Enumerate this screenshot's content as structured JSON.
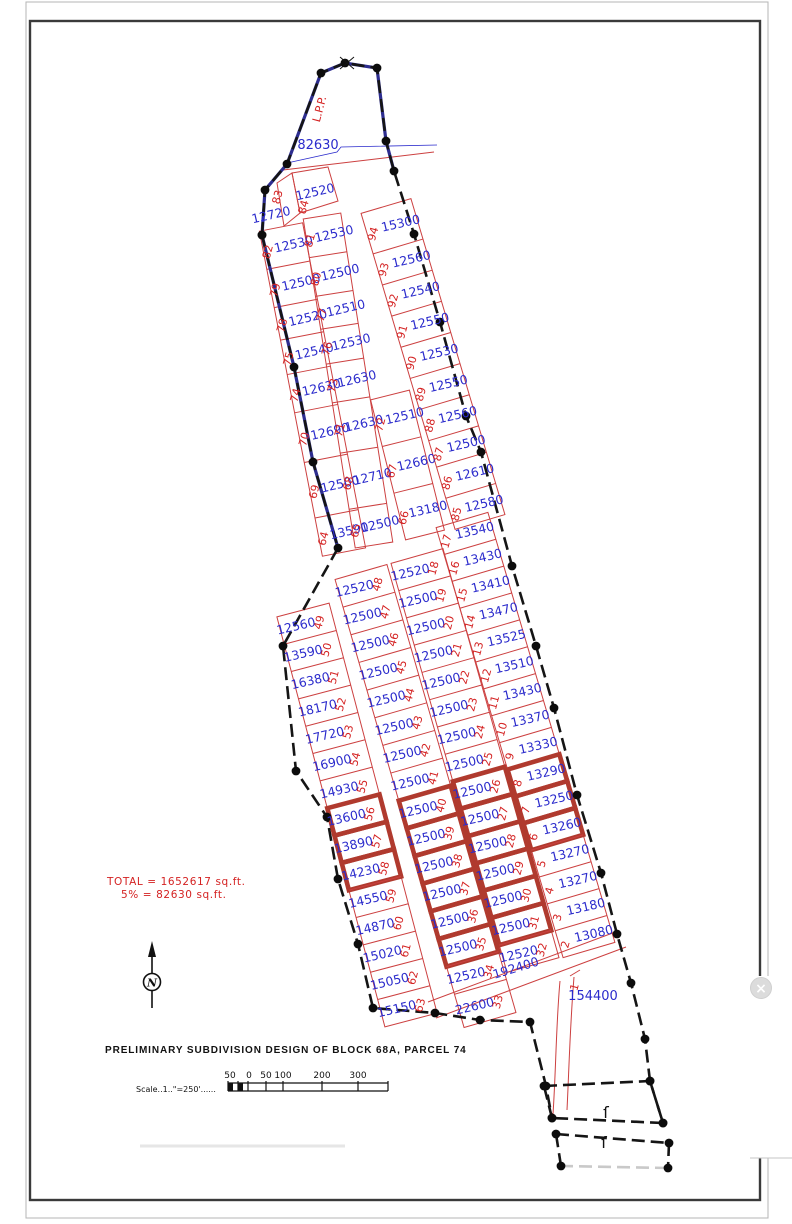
{
  "page": {
    "close_button": "×"
  },
  "title_block": {
    "title": "PRELIMINARY SUBDIVISION DESIGN OF BLOCK 68A, PARCEL 74",
    "scale_label": "Scale..1..\"=250'......",
    "scale_ticks": [
      "50",
      "0",
      "50",
      "100",
      "200",
      "300"
    ],
    "north_label": "N"
  },
  "summary": {
    "total": "TOTAL = 1652617 sq.ft.",
    "open_space": "5% = 82630 sq.ft."
  },
  "map": {
    "colors": {
      "lot_line": "#cc4040",
      "highlight": "#b03a2e",
      "area_text": "#2b2bcc",
      "number_text": "#d42222",
      "boundary": "#151515",
      "boundary_navy": "#2d2d8f"
    },
    "annotations": [
      {
        "text": "82630",
        "x": 318,
        "y": 149,
        "rot": 0,
        "c": "#2b2bcc",
        "s": 13
      },
      {
        "text": "L.P.P.",
        "x": 323,
        "y": 110,
        "rot": -75,
        "c": "#d42222",
        "s": 11
      },
      {
        "text": "12720",
        "x": 272,
        "y": 219,
        "rot": -13,
        "c": "#2b2bcc",
        "s": 12.4
      },
      {
        "text": "83",
        "x": 281,
        "y": 198,
        "rot": -75,
        "c": "#d42222",
        "s": 11
      },
      {
        "text": "12520",
        "x": 316,
        "y": 196,
        "rot": -13,
        "c": "#2b2bcc",
        "s": 12.4
      },
      {
        "text": "84",
        "x": 307,
        "y": 208,
        "rot": -75,
        "c": "#d42222",
        "s": 11
      },
      {
        "text": "192400",
        "x": 517,
        "y": 972,
        "rot": -17,
        "c": "#2b2bcc",
        "s": 12.4
      },
      {
        "text": "154400",
        "x": 593,
        "y": 1000,
        "rot": 0,
        "c": "#2b2bcc",
        "s": 13
      },
      {
        "text": "1",
        "x": 578,
        "y": 988,
        "rot": -75,
        "c": "#d42222",
        "s": 11
      },
      {
        "text": "ſ",
        "x": 606,
        "y": 1118,
        "rot": 0,
        "c": "#111111",
        "s": 16
      },
      {
        "text": "ſ",
        "x": 604,
        "y": 1148,
        "rot": 0,
        "c": "#111111",
        "s": 16
      }
    ],
    "columns": [
      {
        "id": "upper-west-a",
        "numSide": -1,
        "top": [
          281,
          227
        ],
        "bottom": [
          344,
          552
        ],
        "width": 44,
        "lots": [
          {
            "n": 82,
            "a": 12530
          },
          {
            "n": 79,
            "a": 12500
          },
          {
            "n": 78,
            "a": 12520,
            "len": 0.85
          },
          {
            "n": 75,
            "a": 12540,
            "len": 0.9
          },
          {
            "n": 74,
            "a": 12630
          },
          {
            "n": 70,
            "a": 12690,
            "len": 1.3
          },
          {
            "n": 69,
            "a": 12500,
            "len": 1.45
          },
          {
            "n": 64,
            "a": 13590
          }
        ]
      },
      {
        "id": "upper-west-b",
        "numSide": -1,
        "top": [
          322,
          216
        ],
        "bottom": [
          374,
          545
        ],
        "width": 38,
        "lots": [
          {
            "n": 81,
            "a": 12530
          },
          {
            "n": 80,
            "a": 12500
          },
          {
            "n": 77,
            "a": 12510,
            "len": 0.85
          },
          {
            "n": 76,
            "a": 12530,
            "len": 0.9
          },
          {
            "n": 73,
            "a": 12630
          },
          {
            "n": 71,
            "a": 12630,
            "len": 1.3
          },
          {
            "n": 68,
            "a": 12710,
            "len": 1.45
          },
          {
            "n": 65,
            "a": 12500
          }
        ]
      },
      {
        "id": "upper-west-c",
        "numSide": -1,
        "top": [
          390,
          395
        ],
        "bottom": [
          425,
          535
        ],
        "width": 40,
        "lots": [
          {
            "n": 72,
            "a": 12510
          },
          {
            "n": 67,
            "a": 12660
          },
          {
            "n": 66,
            "a": 13180
          }
        ]
      },
      {
        "id": "upper-east",
        "numSide": -1,
        "top": [
          386,
          206
        ],
        "bottom": [
          480,
          522
        ],
        "width": 52,
        "lots": [
          {
            "n": 94,
            "a": 15300,
            "len": 1.3
          },
          {
            "n": 93,
            "a": 12560
          },
          {
            "n": 92,
            "a": 12540
          },
          {
            "n": 91,
            "a": 12550
          },
          {
            "n": 90,
            "a": 12530
          },
          {
            "n": 89,
            "a": 12550
          },
          {
            "n": 88,
            "a": 12560
          },
          {
            "n": 87,
            "a": 12500,
            "len": 0.85
          },
          {
            "n": 86,
            "a": 12610
          },
          {
            "n": 85,
            "a": 12580
          }
        ]
      },
      {
        "id": "west",
        "numSide": 1,
        "top": [
          303,
          610
        ],
        "bottom": [
          411,
          1020
        ],
        "width": 54,
        "lots": [
          {
            "n": 49,
            "a": 12560
          },
          {
            "n": 50,
            "a": 13590
          },
          {
            "n": 51,
            "a": 16380
          },
          {
            "n": 52,
            "a": 18170
          },
          {
            "n": 53,
            "a": 17720
          },
          {
            "n": 54,
            "a": 16900
          },
          {
            "n": 55,
            "a": 14930
          },
          {
            "n": 56,
            "a": 13600,
            "hl": true
          },
          {
            "n": 57,
            "a": 13890,
            "hl": true
          },
          {
            "n": 58,
            "a": 14230,
            "hl": true
          },
          {
            "n": 59,
            "a": 14550
          },
          {
            "n": 60,
            "a": 14870
          },
          {
            "n": 61,
            "a": 15020
          },
          {
            "n": 62,
            "a": 15050
          },
          {
            "n": 63,
            "a": 15150
          }
        ]
      },
      {
        "id": "center-left",
        "numSide": 1,
        "top": [
          361,
          572
        ],
        "bottom": [
          490,
          1020
        ],
        "width": 54,
        "lots": [
          {
            "n": 48,
            "a": 12520
          },
          {
            "n": 47,
            "a": 12500
          },
          {
            "n": 46,
            "a": 12500
          },
          {
            "n": 45,
            "a": 12500
          },
          {
            "n": 44,
            "a": 12500
          },
          {
            "n": 43,
            "a": 12500
          },
          {
            "n": 42,
            "a": 12500
          },
          {
            "n": 41,
            "a": 12500
          },
          {
            "n": 40,
            "a": 12500,
            "hl": true
          },
          {
            "n": 39,
            "a": 12500,
            "hl": true
          },
          {
            "n": 38,
            "a": 12500,
            "hl": true
          },
          {
            "n": 37,
            "a": 12500,
            "hl": true
          },
          {
            "n": 36,
            "a": 12500,
            "hl": true
          },
          {
            "n": 35,
            "a": 12500,
            "hl": true
          },
          {
            "n": 34,
            "a": 12520
          },
          {
            "n": 33,
            "a": 22600,
            "len": 1.2
          }
        ]
      },
      {
        "id": "center-right",
        "numSide": 1,
        "top": [
          417,
          556
        ],
        "bottom": [
          533,
          965
        ],
        "width": 54,
        "lots": [
          {
            "n": 18,
            "a": 12520
          },
          {
            "n": 19,
            "a": 12500
          },
          {
            "n": 20,
            "a": 12500
          },
          {
            "n": 21,
            "a": 12500
          },
          {
            "n": 22,
            "a": 12500
          },
          {
            "n": 23,
            "a": 12500
          },
          {
            "n": 24,
            "a": 12500
          },
          {
            "n": 25,
            "a": 12500
          },
          {
            "n": 26,
            "a": 12500,
            "hl": true
          },
          {
            "n": 27,
            "a": 12500,
            "hl": true
          },
          {
            "n": 28,
            "a": 12500,
            "hl": true
          },
          {
            "n": 29,
            "a": 12500,
            "hl": true
          },
          {
            "n": 30,
            "a": 12500,
            "hl": true
          },
          {
            "n": 31,
            "a": 12500,
            "hl": true
          },
          {
            "n": 32,
            "a": 12520
          }
        ]
      },
      {
        "id": "east",
        "numSide": -1,
        "top": [
          462,
          520
        ],
        "bottom": [
          589,
          950
        ],
        "width": 54,
        "lots": [
          {
            "n": 17,
            "a": 13540
          },
          {
            "n": 16,
            "a": 13430
          },
          {
            "n": 15,
            "a": 13410
          },
          {
            "n": 14,
            "a": 13470
          },
          {
            "n": 13,
            "a": 13525
          },
          {
            "n": 12,
            "a": 13510
          },
          {
            "n": 11,
            "a": 13430
          },
          {
            "n": 10,
            "a": 13370
          },
          {
            "n": 9,
            "a": 13330
          },
          {
            "n": 8,
            "a": 13290,
            "hl": true
          },
          {
            "n": 7,
            "a": 13250,
            "hl": true
          },
          {
            "n": 6,
            "a": 13260,
            "hl": true
          },
          {
            "n": 5,
            "a": 13270
          },
          {
            "n": 4,
            "a": 13270
          },
          {
            "n": 3,
            "a": 13180
          },
          {
            "n": 2,
            "a": 13080
          }
        ]
      }
    ],
    "boundary": {
      "right_chain": [
        [
          262,
          235
        ],
        [
          265,
          190
        ],
        [
          287,
          164
        ],
        [
          321,
          73
        ],
        [
          345,
          63
        ],
        [
          377,
          68
        ],
        [
          386,
          141
        ],
        [
          394,
          171
        ],
        [
          414,
          234
        ],
        [
          440,
          322
        ],
        [
          466,
          416
        ],
        [
          481,
          452
        ],
        [
          512,
          566
        ],
        [
          536,
          646
        ],
        [
          554,
          708
        ],
        [
          577,
          795
        ],
        [
          601,
          873
        ],
        [
          617,
          934
        ],
        [
          631,
          983
        ],
        [
          645,
          1039
        ],
        [
          650,
          1081
        ],
        [
          663,
          1123
        ]
      ],
      "left_chain": [
        [
          262,
          235
        ],
        [
          294,
          367
        ],
        [
          313,
          462
        ],
        [
          338,
          548
        ],
        [
          283,
          646
        ],
        [
          296,
          771
        ],
        [
          327,
          817
        ],
        [
          338,
          879
        ],
        [
          358,
          944
        ],
        [
          373,
          1008
        ],
        [
          435,
          1013
        ],
        [
          480,
          1020
        ],
        [
          530,
          1022
        ],
        [
          546,
          1086
        ],
        [
          552,
          1118
        ]
      ],
      "navy": [
        [
          [
            262,
            235
          ],
          [
            265,
            190
          ],
          [
            287,
            164
          ],
          [
            321,
            73
          ],
          [
            345,
            63
          ],
          [
            377,
            68
          ],
          [
            386,
            141
          ],
          [
            394,
            171
          ]
        ],
        [
          [
            262,
            235
          ],
          [
            294,
            367
          ],
          [
            313,
            462
          ],
          [
            338,
            548
          ]
        ]
      ],
      "x_mark": [
        347,
        63
      ],
      "quads": [
        {
          "pts": [
            [
              544,
              1086
            ],
            [
              650,
              1081
            ],
            [
              663,
              1123
            ],
            [
              552,
              1118
            ]
          ],
          "light_bottom": false
        },
        {
          "pts": [
            [
              556,
              1134
            ],
            [
              669,
              1143
            ],
            [
              668,
              1168
            ],
            [
              561,
              1166
            ]
          ],
          "light_bottom": true
        }
      ]
    },
    "extra_red_paths": [
      "M292,173 L328,167 L338,201 L300,213 Z",
      "M277,183 L292,173 L300,213 L284,226 Z",
      "M283,170 L434,152",
      "M428,1002 L618,931",
      "M436,1018 L626,947",
      "M560,981 C556,1025 556,1070 553,1114",
      "M574,977 C570,1025 569,1070 567,1110",
      "M570,976 L580,970"
    ],
    "leader_blue": "M287,163 L337,152 L341,147 L437,145"
  }
}
